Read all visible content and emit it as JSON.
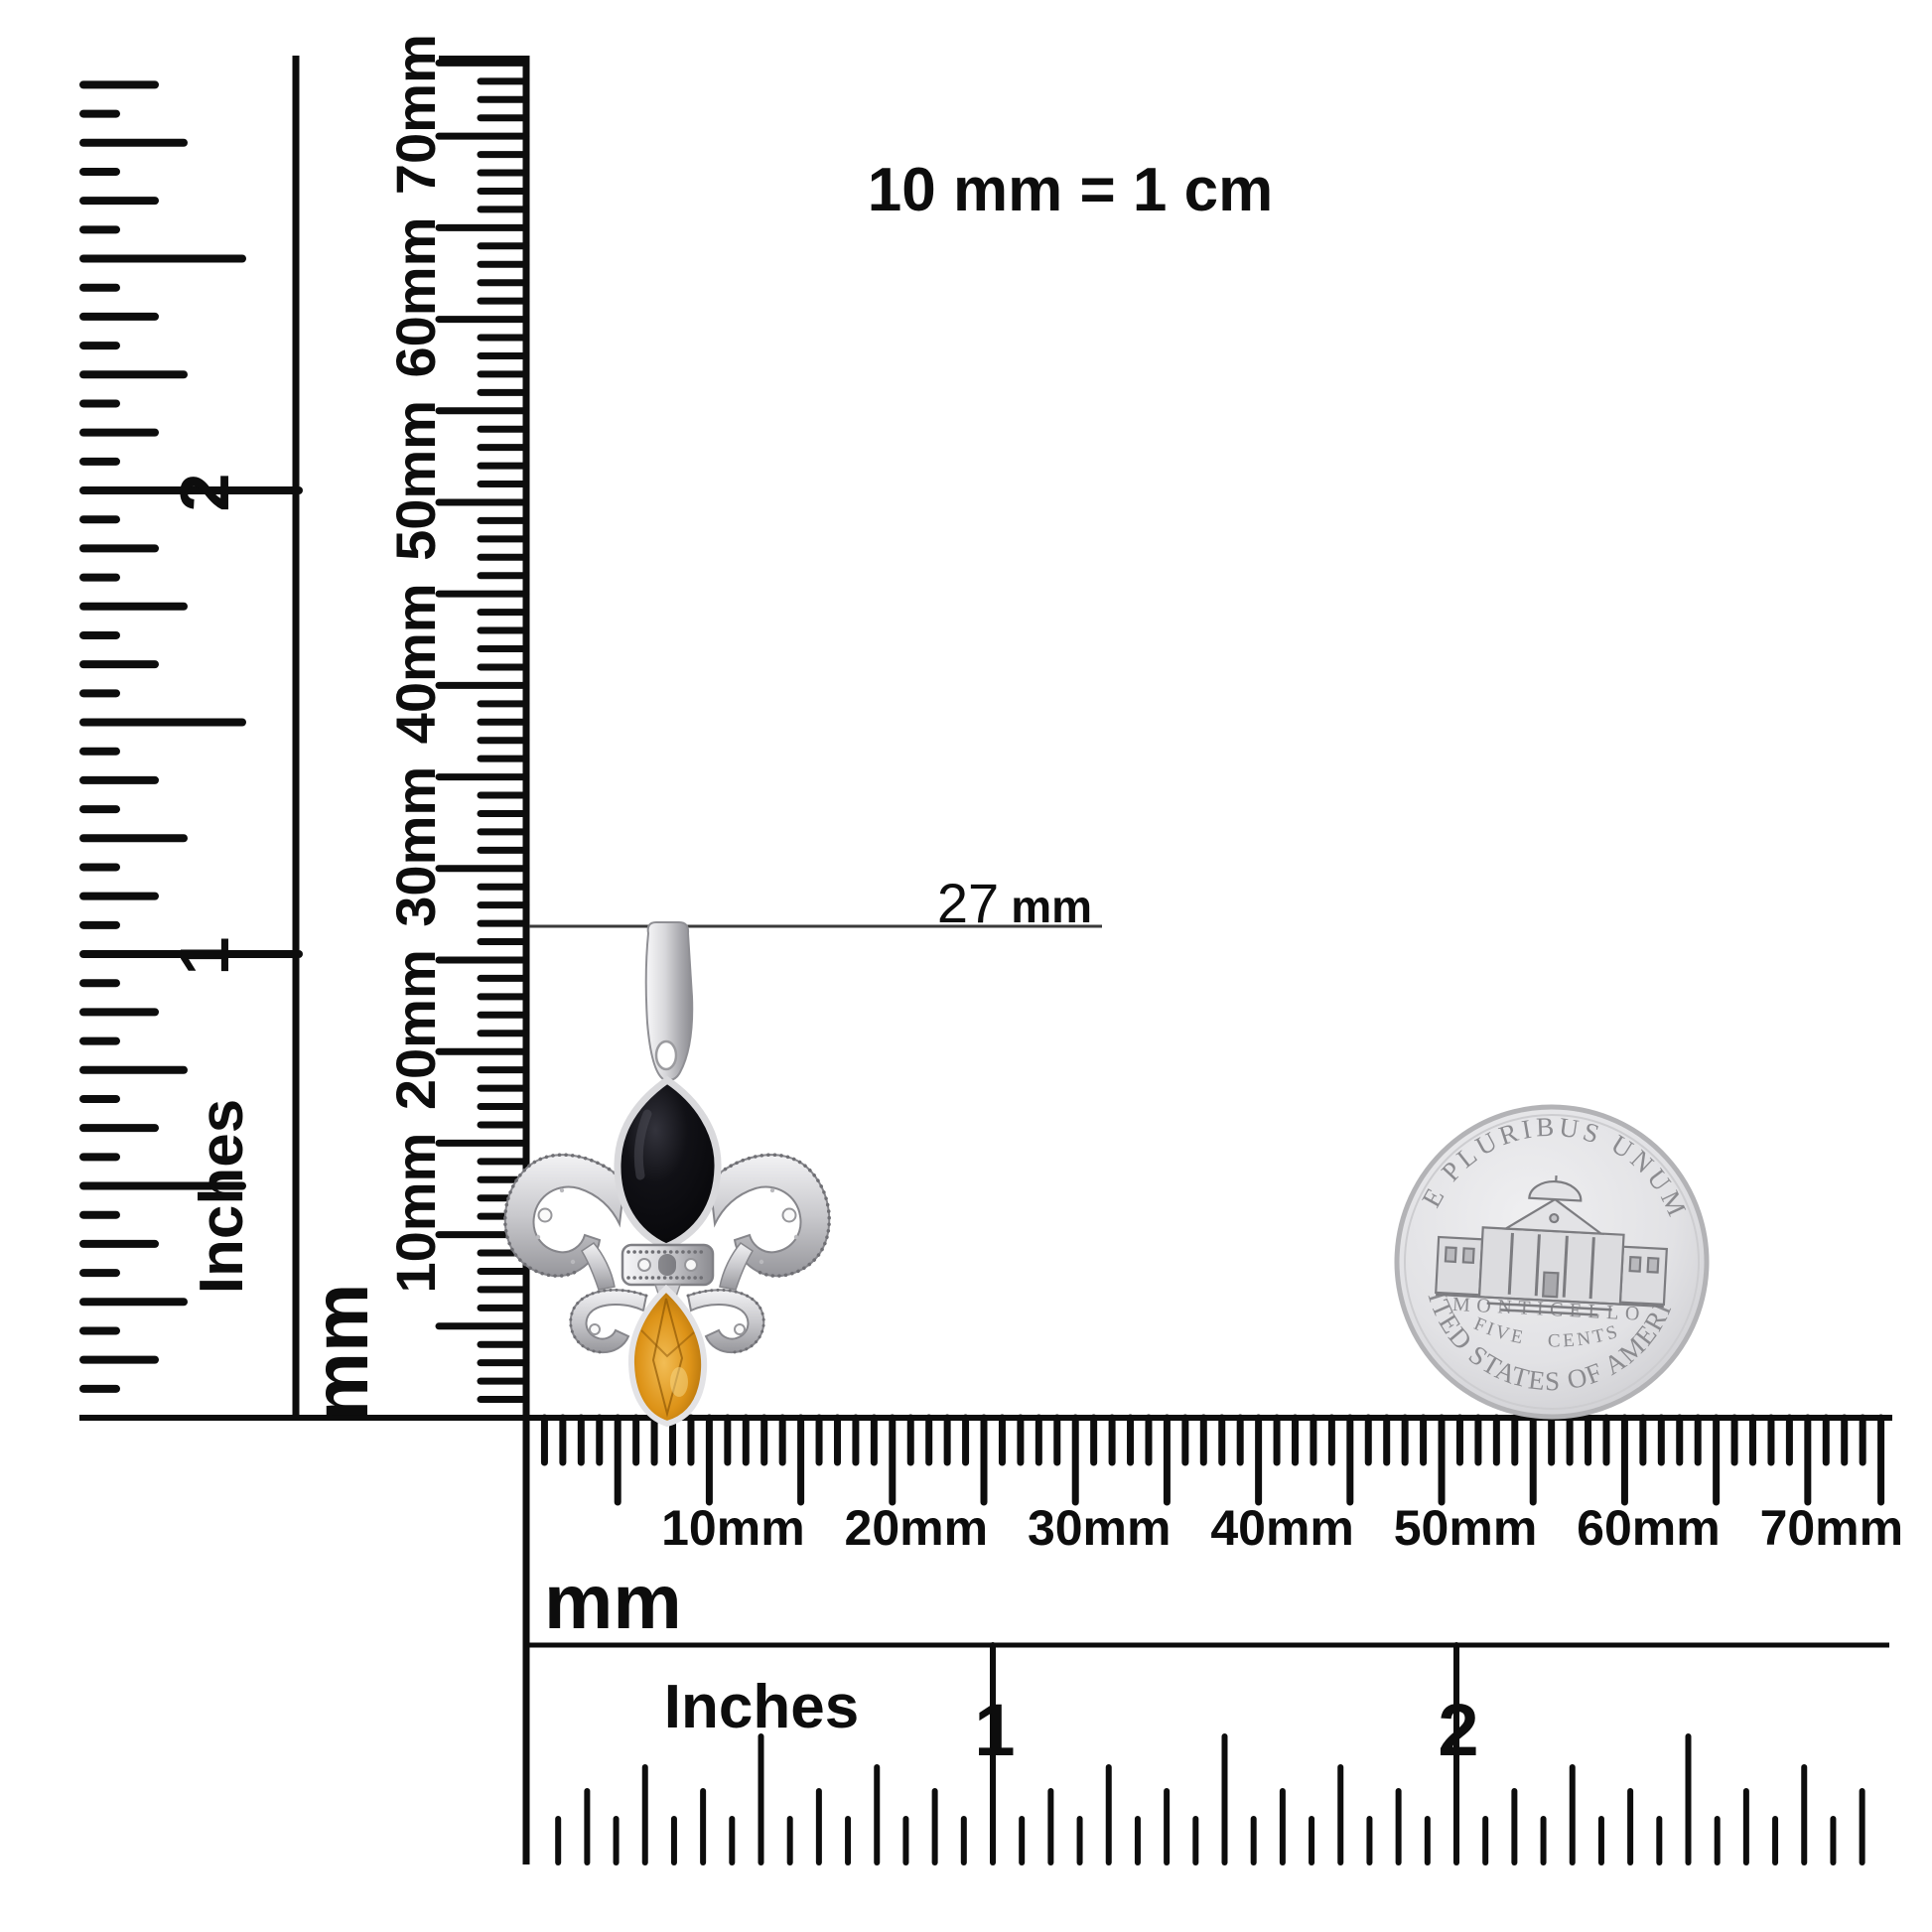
{
  "scale_note": "10 mm = 1 cm",
  "annotation": {
    "label": "27 mm",
    "value": "27",
    "unit": "mm"
  },
  "rulers": {
    "left_inches": {
      "unit_label": "Inches",
      "tick_labels": [
        "1",
        "2"
      ]
    },
    "vertical_mm": {
      "unit_label": "mm",
      "tick_labels": [
        "10mm",
        "20mm",
        "30mm",
        "40mm",
        "50mm",
        "60mm",
        "70mm"
      ]
    },
    "horizontal_mm": {
      "unit_label": "mm",
      "tick_labels": [
        "10mm",
        "20mm",
        "30mm",
        "40mm",
        "50mm",
        "60mm",
        "70mm"
      ]
    },
    "bottom_inches": {
      "unit_label": "Inches",
      "tick_labels": [
        "1",
        "2"
      ]
    }
  },
  "coin": {
    "top_text": "E PLURIBUS UNUM",
    "building_label": "MONTICELLO",
    "denomination": "FIVE CENTS",
    "bottom_text": "UNITED STATES OF AMERICA"
  },
  "pendant": {
    "description": "fleur-de-lis pendant with black onyx and citrine marquise stones",
    "colors": {
      "onyx": "#0b0b0e",
      "citrine": "#d98a12",
      "silver": "#d7d7d9"
    }
  },
  "colors": {
    "ink": "#0d0d0d",
    "background": "#ffffff",
    "annotation_line": "#3a3a3a",
    "coin_text": "#8b8b8f"
  }
}
